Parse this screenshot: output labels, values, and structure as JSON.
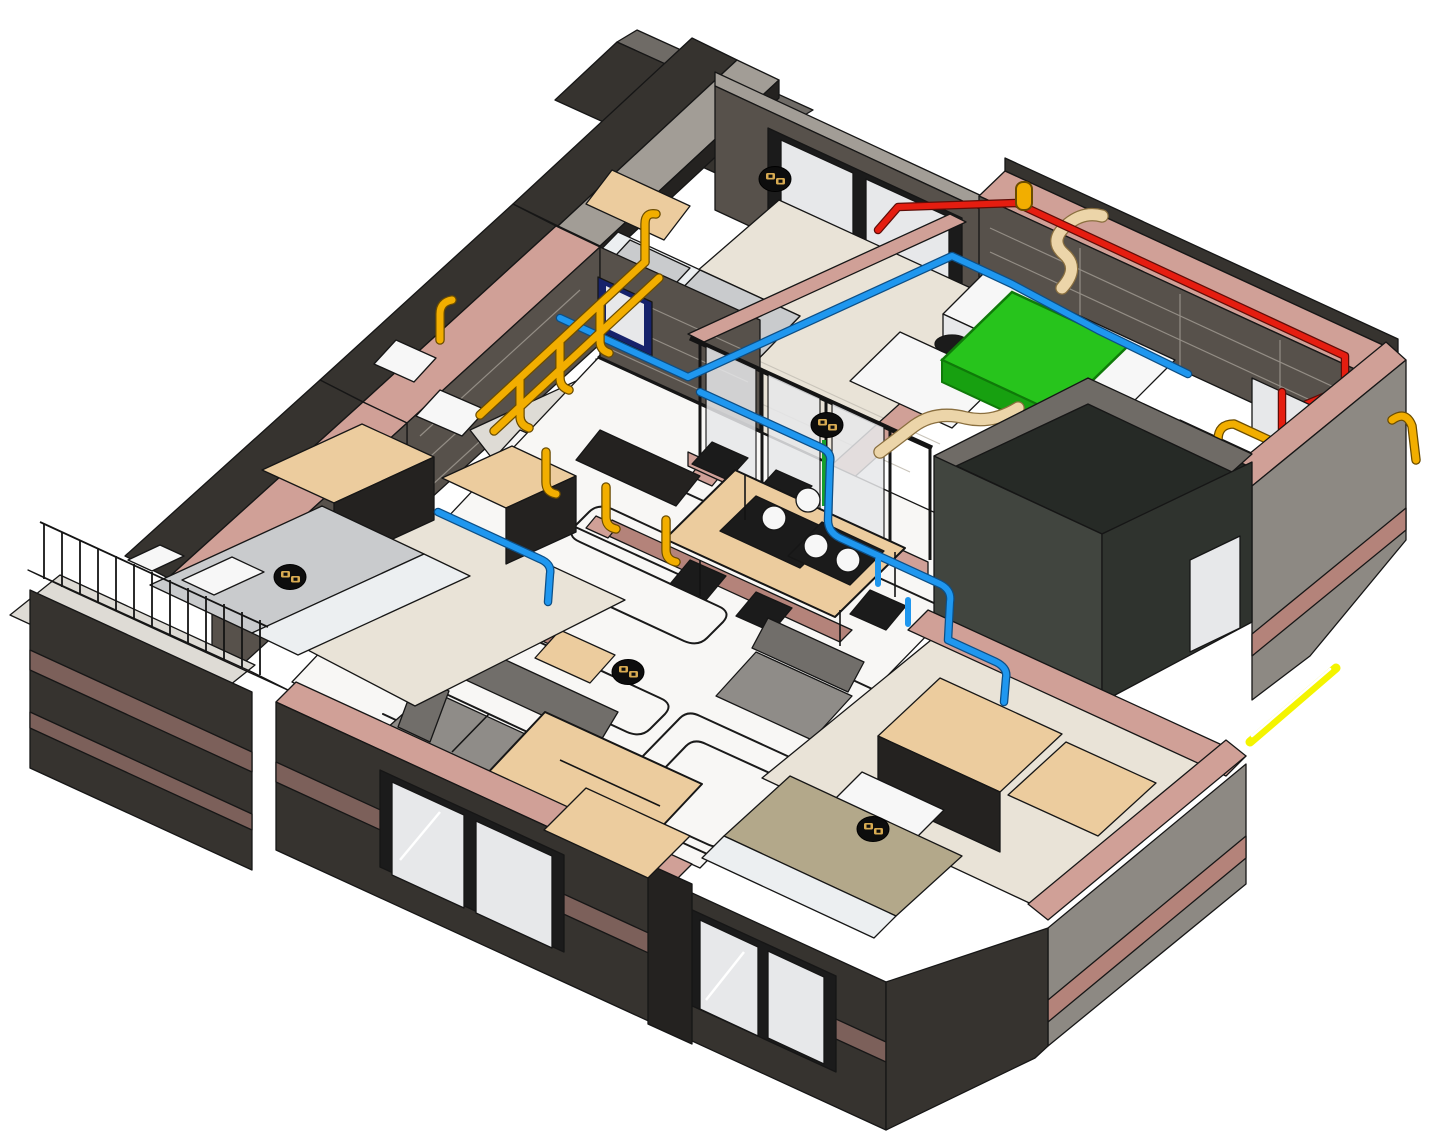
{
  "view": {
    "kind": "bim-3d-axonometric-cutaway-apartment",
    "background": "#ffffff"
  },
  "colors": {
    "bg": "#ffffff",
    "wall_dark": "#36332f",
    "wall_darker": "#242220",
    "wall_face_l": "#8d8983",
    "wall_face_m": "#57514b",
    "slab_top": "#a29d96",
    "slab_gray": "#6f6b66",
    "cap_pink": "#d0a097",
    "cap_pink_dk": "#b4837a",
    "stripe_mauve": "#7c605a",
    "floor_white": "#f8f7f5",
    "floor_gray": "#dedbd5",
    "floor_tan": "#e9e3d7",
    "furn_tan": "#eccc9e",
    "furn_tan_dk": "#d9b07f",
    "bed_white": "#eceff1",
    "bed_gray": "#c9cbcd",
    "khaki": "#b3a88a",
    "sofa": "#8f8c88",
    "sofa_dk": "#716e6a",
    "glass": "#e7e8ea",
    "navy": "#16226b",
    "green": "#27c41c",
    "duct_tan": "#ecd5a9",
    "blue": "#1f97ef",
    "yellow": "#f2ae00",
    "red": "#e51d10",
    "neon": "#f4f400",
    "marker_body": "#0d0d0d",
    "marker_glyph": "#d8ab52"
  },
  "systems": [
    {
      "id": "electrical-conduit",
      "color_key": "yellow"
    },
    {
      "id": "water-supply-pipe",
      "color_key": "blue"
    },
    {
      "id": "hot-water-pipe",
      "color_key": "red"
    },
    {
      "id": "fresh-air-unit",
      "color_key": "green"
    },
    {
      "id": "flexible-duct",
      "color_key": "duct_tan"
    },
    {
      "id": "floor-heating-coil",
      "color_key": "wall_darker"
    },
    {
      "id": "external-feed-line",
      "color_key": "neon"
    }
  ],
  "devices": {
    "count": 5,
    "icon": "power-socket-marker",
    "body_color_key": "marker_body",
    "glyph_color_key": "marker_glyph"
  }
}
